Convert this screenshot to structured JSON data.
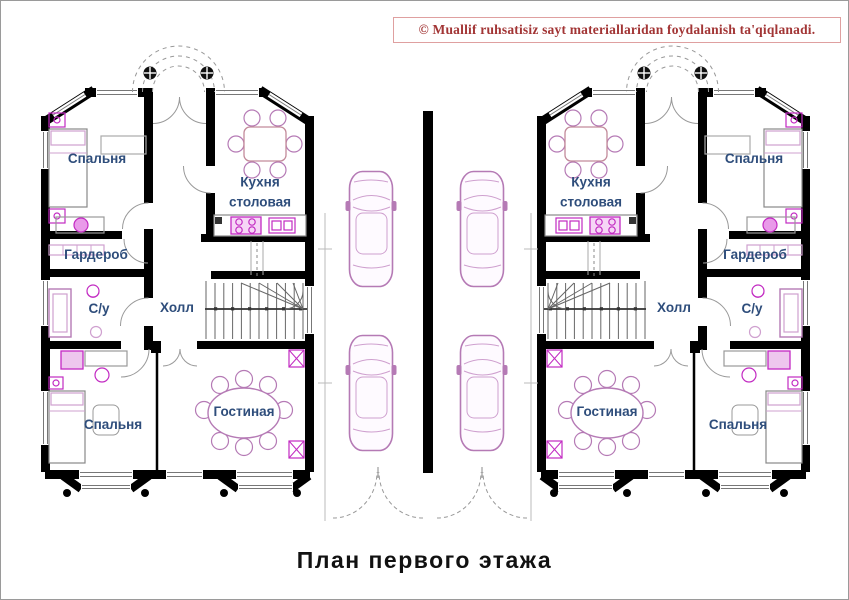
{
  "page": {
    "title": "План первого этажа",
    "copyright": "© Muallif ruhsatisiz sayt materiallaridan foydalanish ta'qiqlanadi."
  },
  "houses": [
    {
      "side": "left",
      "rooms": [
        {
          "id": "bedroom-top",
          "label": "Спальня"
        },
        {
          "id": "kitchen-dining",
          "label": "Кухня столовая"
        },
        {
          "id": "wardrobe",
          "label": "Гардероб"
        },
        {
          "id": "bathroom",
          "label": "С/у"
        },
        {
          "id": "hall",
          "label": "Холл"
        },
        {
          "id": "bedroom-bottom",
          "label": "Спальня"
        },
        {
          "id": "living-room",
          "label": "Гостиная"
        }
      ]
    },
    {
      "side": "right",
      "rooms": [
        {
          "id": "bedroom-top",
          "label": "Спальня"
        },
        {
          "id": "kitchen-dining",
          "label": "Кухня столовая"
        },
        {
          "id": "wardrobe",
          "label": "Гардероб"
        },
        {
          "id": "bathroom",
          "label": "С/у"
        },
        {
          "id": "hall",
          "label": "Холл"
        },
        {
          "id": "bedroom-bottom",
          "label": "Спальня"
        },
        {
          "id": "living-room",
          "label": "Гостиная"
        }
      ]
    }
  ],
  "colors": {
    "wall": "#000000",
    "room_label": "#2e4d7b",
    "furniture_magenta": "#c22ac2",
    "furniture_violet": "#b57ab5",
    "copyright_red": "#a23535",
    "line_gray": "#999999"
  }
}
